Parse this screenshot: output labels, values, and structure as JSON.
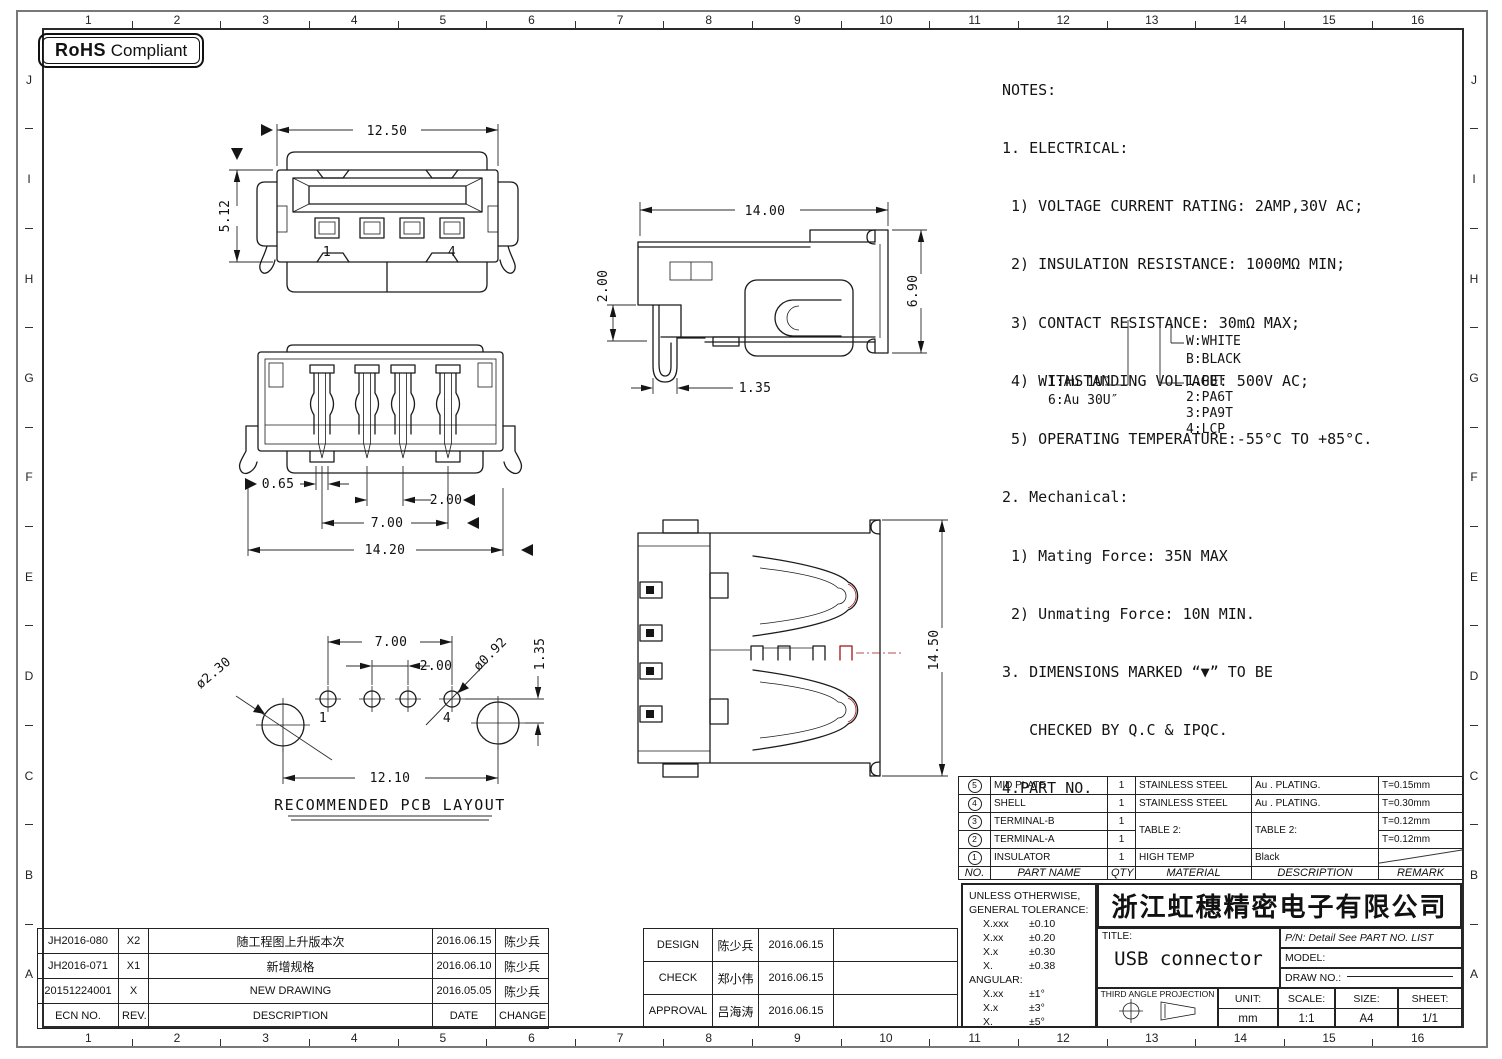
{
  "badge": {
    "bold": "RoHS",
    "rest": "Compliant"
  },
  "sheet": {
    "grid_cols": [
      "1",
      "2",
      "3",
      "4",
      "5",
      "6",
      "7",
      "8",
      "9",
      "10",
      "11",
      "12",
      "13",
      "14",
      "15",
      "16"
    ],
    "grid_rows": [
      "J",
      "I",
      "H",
      "G",
      "F",
      "E",
      "D",
      "C",
      "B",
      "A"
    ]
  },
  "notes": {
    "lines": [
      "NOTES:",
      "1. ELECTRICAL:",
      " 1) VOLTAGE CURRENT RATING: 2AMP,30V AC;",
      " 2) INSULATION RESISTANCE: 1000MΩ MIN;",
      " 3) CONTACT RESISTANCE: 30mΩ MAX;",
      " 4) WITHSTANDING VOLTAGE: 500V AC;",
      " 5) OPERATING TEMPERATURE:-55°C TO +85°C.",
      "2. Mechanical:",
      " 1) Mating Force: 35N MAX",
      " 2) Unmating Force: 10N MIN.",
      "3. DIMENSIONS MARKED “▼” TO BE",
      "   CHECKED BY Q.C & IPQC.",
      "4.PART NO."
    ]
  },
  "partno": {
    "au1": "1:Au 1U″",
    "au6": "6:Au 30U″",
    "w": "W:WHITE",
    "b": "B:BLACK",
    "m1": "1:PBT",
    "m2": "2:PA6T",
    "m3": "3:PA9T",
    "m4": "4:LCP"
  },
  "views": {
    "front": {
      "width": "12.50",
      "height": "5.12",
      "pin_first": "1",
      "pin_last": "4"
    },
    "bottom": {
      "pin_width": "0.65",
      "pitch": "2.00",
      "span": "7.00",
      "body_width": "14.20"
    },
    "side": {
      "length": "14.00",
      "height": "6.90",
      "lead": "2.00",
      "tail": "1.35"
    },
    "top": {
      "depth": "14.50"
    },
    "pcb": {
      "span": "7.00",
      "pitch": "2.00",
      "hole_small": "ø0.92",
      "offset": "1.35",
      "hole_big": "ø2.30",
      "mount_span": "12.10",
      "pin_first": "1",
      "pin_last": "4",
      "caption": "RECOMMENDED PCB LAYOUT"
    }
  },
  "bom": {
    "headers": {
      "no": "NO.",
      "part": "PART NAME",
      "qty": "QTY",
      "material": "MATERIAL",
      "desc": "DESCRIPTION",
      "remark": "REMARK"
    },
    "rows": [
      {
        "no": "5",
        "part": "MID PLATE",
        "qty": "1",
        "material": "STAINLESS STEEL",
        "desc": "Au . PLATING.",
        "remark": "T=0.15mm"
      },
      {
        "no": "4",
        "part": "SHELL",
        "qty": "1",
        "material": "STAINLESS STEEL",
        "desc": "Au . PLATING.",
        "remark": "T=0.30mm"
      },
      {
        "no": "3",
        "part": "TERMINAL-B",
        "qty": "1",
        "material": "TABLE 2:",
        "desc": "TABLE 2:",
        "remark": "T=0.12mm"
      },
      {
        "no": "2",
        "part": "TERMINAL-A",
        "qty": "1",
        "material": "",
        "desc": "",
        "remark": "T=0.12mm"
      },
      {
        "no": "1",
        "part": "INSULATOR",
        "qty": "1",
        "material": "HIGH TEMP",
        "desc": "Black",
        "remark": ""
      }
    ]
  },
  "tolerance": {
    "l1": "UNLESS OTHERWISE,",
    "l2": "GENERAL TOLERANCE:",
    "rows": [
      [
        "X.xxx",
        "±0.10"
      ],
      [
        "X.xx",
        "±0.20"
      ],
      [
        "X.x",
        "±0.30"
      ],
      [
        "X.",
        "±0.38"
      ]
    ],
    "angular": "ANGULAR:",
    "arows": [
      [
        "X.xx",
        "±1°"
      ],
      [
        "X.x",
        "±3°"
      ],
      [
        "X.",
        "±5°"
      ]
    ]
  },
  "titleblock": {
    "company": "浙江虹穗精密电子有限公司",
    "title_label": "TITLE:",
    "title_value": "USB connector",
    "pn": "P/N: Detail See PART NO. LIST",
    "model_label": "MODEL:",
    "drawno_label": "DRAW NO.:",
    "projection": "THIRD ANGLE PROJECTION",
    "unit_label": "UNIT:",
    "unit_value": "mm",
    "scale_label": "SCALE:",
    "scale_value": "1:1",
    "size_label": "SIZE:",
    "size_value": "A4",
    "sheet_label": "SHEET:",
    "sheet_value": "1/1"
  },
  "revisions": {
    "headers": {
      "ecn": "ECN NO.",
      "rev": "REV.",
      "desc": "DESCRIPTION",
      "date": "DATE",
      "change": "CHANGE"
    },
    "rows": [
      {
        "ecn": "JH2016-080",
        "rev": "X2",
        "desc": "随工程图上升版本次",
        "date": "2016.06.15",
        "change": "陈少兵"
      },
      {
        "ecn": "JH2016-071",
        "rev": "X1",
        "desc": "新增规格",
        "date": "2016.06.10",
        "change": "陈少兵"
      },
      {
        "ecn": "20151224001",
        "rev": "X",
        "desc": "NEW DRAWING",
        "date": "2016.05.05",
        "change": "陈少兵"
      }
    ]
  },
  "approvals": {
    "rows": [
      {
        "role": "DESIGN",
        "name": "陈少兵",
        "date": "2016.06.15"
      },
      {
        "role": "CHECK",
        "name": "郑小伟",
        "date": "2016.06.15"
      },
      {
        "role": "APPROVAL",
        "name": "吕海涛",
        "date": "2016.06.15"
      }
    ]
  }
}
